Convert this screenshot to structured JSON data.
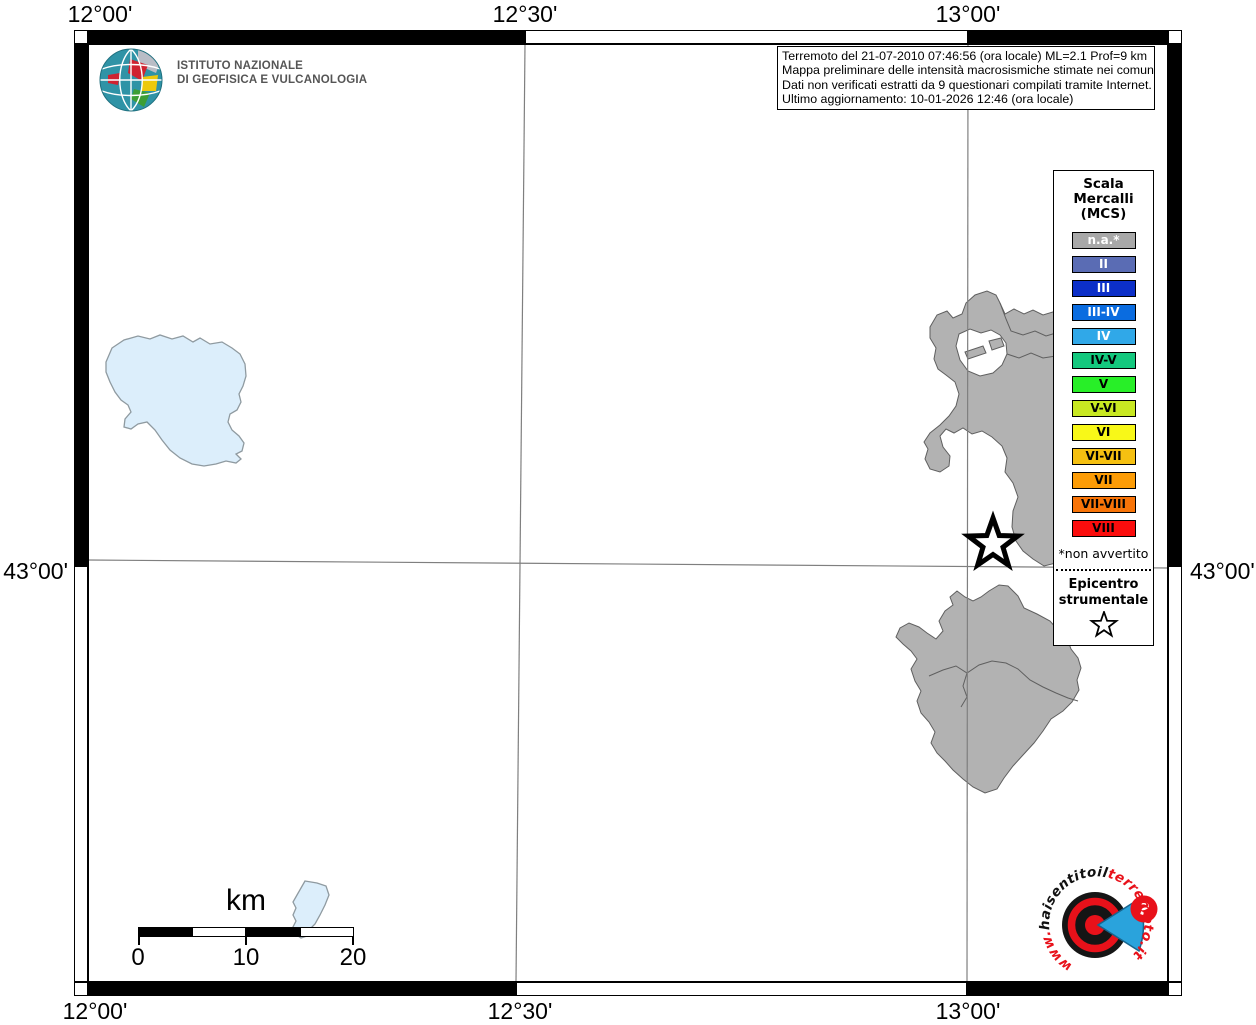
{
  "colors": {
    "land": "#b2b2b2",
    "lake": "#dceefb",
    "grid": "#7f7f7f",
    "logo_red": "#e8111a",
    "logo_blue": "#2aa3dc",
    "logo_black": "#151515"
  },
  "axis": {
    "top": [
      "12°00'",
      "12°30'",
      "13°00'"
    ],
    "bottom": [
      "12°00'",
      "12°30'",
      "13°00'"
    ],
    "left": "43°00'",
    "right": "43°00'"
  },
  "info_box": {
    "lines": [
      "Terremoto del 21-07-2010 07:46:56 (ora locale) ML=2.1 Prof=9 km",
      "Mappa preliminare delle intensità macrosismiche stimate nei comuni",
      "Dati non verificati estratti da 9 questionari compilati tramite Internet.",
      "Ultimo aggiornamento: 10-01-2026 12:46 (ora locale)"
    ]
  },
  "legend": {
    "title_lines": [
      "Scala",
      "Mercalli",
      "(MCS)"
    ],
    "items": [
      {
        "label": "n.a.*",
        "color": "#a8a8a8",
        "text_color": "#ffffff"
      },
      {
        "label": "II",
        "color": "#5a6cb4",
        "text_color": "#ffffff"
      },
      {
        "label": "III",
        "color": "#0c2fc8",
        "text_color": "#ffffff"
      },
      {
        "label": "III-IV",
        "color": "#0a6ce0",
        "text_color": "#ffffff"
      },
      {
        "label": "IV",
        "color": "#30a8e8",
        "text_color": "#ffffff"
      },
      {
        "label": "IV-V",
        "color": "#14c87e",
        "text_color": "#000000"
      },
      {
        "label": "V",
        "color": "#28ef28",
        "text_color": "#000000"
      },
      {
        "label": "V-VI",
        "color": "#c8e822",
        "text_color": "#000000"
      },
      {
        "label": "VI",
        "color": "#f8f818",
        "text_color": "#000000"
      },
      {
        "label": "VI-VII",
        "color": "#f5c011",
        "text_color": "#000000"
      },
      {
        "label": "VII",
        "color": "#fc9c06",
        "text_color": "#000000"
      },
      {
        "label": "VII-VIII",
        "color": "#f87408",
        "text_color": "#000000"
      },
      {
        "label": "VIII",
        "color": "#fb0d0d",
        "text_color": "#000000"
      }
    ],
    "footnote": "*non avvertito",
    "epicenter_lines": [
      "Epicentro",
      "strumentale"
    ]
  },
  "scale_bar": {
    "unit": "km",
    "tick_labels": [
      "0",
      "10",
      "20"
    ]
  },
  "ingv": {
    "name_line1": "ISTITUTO NAZIONALE",
    "name_line2": "DI GEOFISICA E VULCANOLOGIA"
  },
  "footer_logo": {
    "url_www": "www.",
    "url_black": "haisentito",
    "url_il": "il",
    "url_red": "terremoto.it",
    "badge": "?"
  }
}
